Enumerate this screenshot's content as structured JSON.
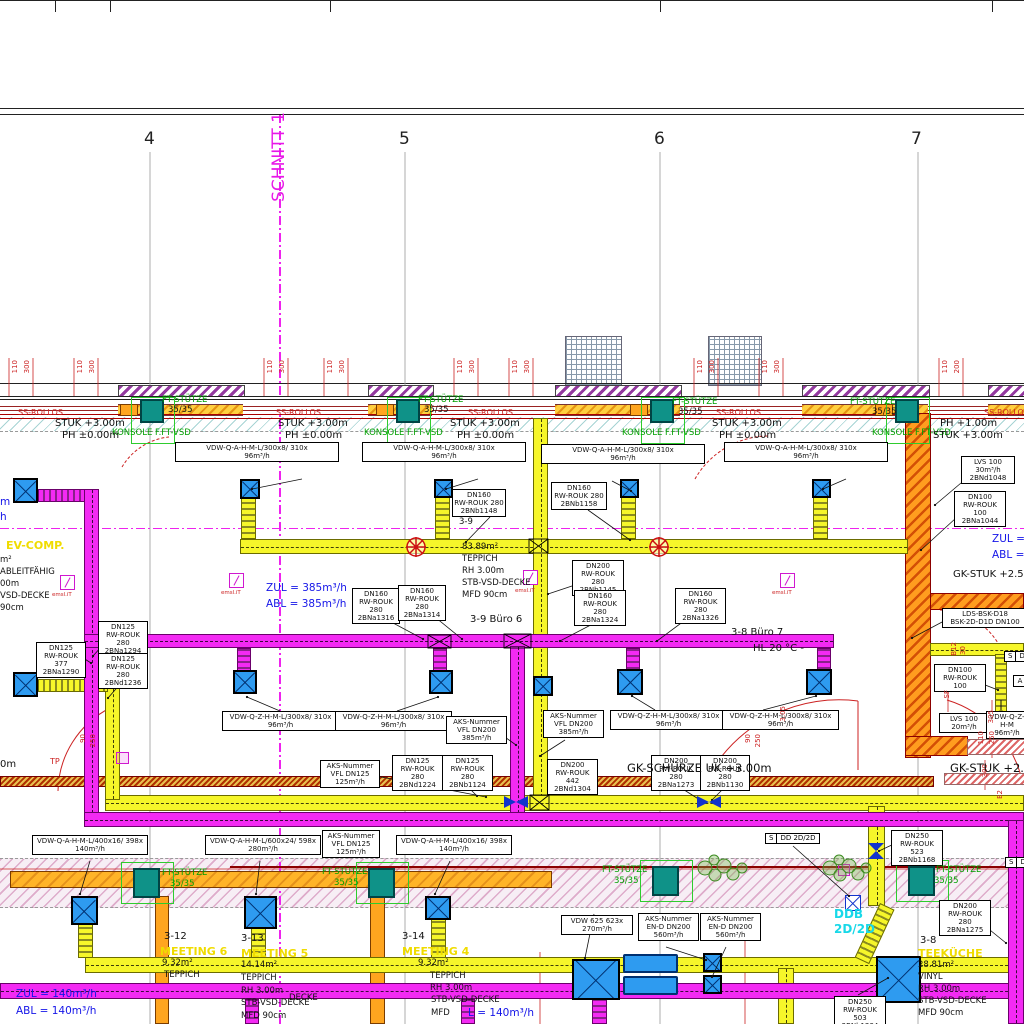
{
  "drawing": {
    "section_label": "SCHNITT 1"
  },
  "grid_axes": [
    "4",
    "5",
    "6",
    "7"
  ],
  "colors": {
    "supply_duct_yellow": "#f6f62a",
    "exhaust_duct_magenta": "#f32af3",
    "column_teal": "#0f9288",
    "wall_orange": "#ff9d1f",
    "purple_hatch": "#93399f",
    "annotation_green": "#00a000",
    "dimension_red": "#cc2222",
    "info_blue": "#1515e8",
    "room_name_yellow": "#f0dc00",
    "ddb_cyan": "#18d8e8",
    "section_magenta": "#e818e8"
  },
  "icons": {
    "diffuser-icon": "blue square with X cross",
    "fire-damper-icon": "red wheel circle",
    "damper-icon": "blue bowtie",
    "vsd-actuator-icon": "magenta square with slash",
    "plant-icon": "green shrub cluster"
  },
  "flags": [
    {
      "x": 765,
      "y": 833,
      "cells": [
        "S",
        "DD 2D/2D"
      ]
    },
    {
      "x": 1004,
      "y": 651,
      "cells": [
        "S",
        "D"
      ]
    },
    {
      "x": 1005,
      "y": 857,
      "cells": [
        "S",
        "DG"
      ]
    }
  ],
  "labels": [
    {
      "t": "4",
      "x": 144,
      "y": 130,
      "c": "gn",
      "n": "grid-axis-4"
    },
    {
      "t": "5",
      "x": 399,
      "y": 130,
      "c": "gn",
      "n": "grid-axis-5"
    },
    {
      "t": "6",
      "x": 654,
      "y": 130,
      "c": "gn",
      "n": "grid-axis-6"
    },
    {
      "t": "7",
      "x": 911,
      "y": 130,
      "c": "gn",
      "n": "grid-axis-7"
    },
    {
      "t": "SCHNITT 1",
      "x": 270,
      "y": 112,
      "c": "m",
      "n": "section-label"
    },
    {
      "t": "110",
      "x": 12,
      "y": 360,
      "c": "rv"
    },
    {
      "t": "300",
      "x": 24,
      "y": 360,
      "c": "rv"
    },
    {
      "t": "110",
      "x": 77,
      "y": 360,
      "c": "rv"
    },
    {
      "t": "300",
      "x": 89,
      "y": 360,
      "c": "rv"
    },
    {
      "t": "110",
      "x": 267,
      "y": 360,
      "c": "rv"
    },
    {
      "t": "300",
      "x": 279,
      "y": 360,
      "c": "rv"
    },
    {
      "t": "110",
      "x": 327,
      "y": 360,
      "c": "rv"
    },
    {
      "t": "300",
      "x": 339,
      "y": 360,
      "c": "rv"
    },
    {
      "t": "110",
      "x": 457,
      "y": 360,
      "c": "rv"
    },
    {
      "t": "300",
      "x": 469,
      "y": 360,
      "c": "rv"
    },
    {
      "t": "110",
      "x": 512,
      "y": 360,
      "c": "rv"
    },
    {
      "t": "300",
      "x": 524,
      "y": 360,
      "c": "rv"
    },
    {
      "t": "110",
      "x": 697,
      "y": 360,
      "c": "rv"
    },
    {
      "t": "300",
      "x": 709,
      "y": 360,
      "c": "rv"
    },
    {
      "t": "110",
      "x": 762,
      "y": 360,
      "c": "rv"
    },
    {
      "t": "300",
      "x": 774,
      "y": 360,
      "c": "rv"
    },
    {
      "t": "110",
      "x": 942,
      "y": 360,
      "c": "rv"
    },
    {
      "t": "200",
      "x": 954,
      "y": 360,
      "c": "rv"
    },
    {
      "t": "FT-STÜTZE",
      "x": 162,
      "y": 396,
      "c": "g"
    },
    {
      "t": "35/35",
      "x": 168,
      "y": 406,
      "c": "t9"
    },
    {
      "t": "FT-STÜTZE",
      "x": 418,
      "y": 396,
      "c": "g"
    },
    {
      "t": "35/35",
      "x": 424,
      "y": 406,
      "c": "t9"
    },
    {
      "t": "FT-STÜTZE",
      "x": 672,
      "y": 398,
      "c": "g"
    },
    {
      "t": "35/35",
      "x": 678,
      "y": 408,
      "c": "t9"
    },
    {
      "t": "FT-STÜTZE",
      "x": 850,
      "y": 398,
      "c": "g"
    },
    {
      "t": "35/35",
      "x": 872,
      "y": 408,
      "c": "t9"
    },
    {
      "t": "KONSOLE F.FT-VSD",
      "x": 112,
      "y": 429,
      "c": "g"
    },
    {
      "t": "KONSOLE F.FT-VSD",
      "x": 364,
      "y": 429,
      "c": "g"
    },
    {
      "t": "KONSOLE F.FT-VSD",
      "x": 622,
      "y": 429,
      "c": "g"
    },
    {
      "t": "KONSOLE F.FT-VSD",
      "x": 872,
      "y": 429,
      "c": "g"
    },
    {
      "t": "SS-ROLLOS",
      "x": 18,
      "y": 409,
      "c": "r"
    },
    {
      "t": "SS-ROLLOS",
      "x": 276,
      "y": 409,
      "c": "r"
    },
    {
      "t": "SS-ROLLOS",
      "x": 468,
      "y": 409,
      "c": "r"
    },
    {
      "t": "SS-ROLLOS",
      "x": 716,
      "y": 409,
      "c": "r"
    },
    {
      "t": "SS-ROLLOS",
      "x": 984,
      "y": 409,
      "c": "r"
    },
    {
      "t": "STUK +3.00m",
      "x": 55,
      "y": 419,
      "c": "t10"
    },
    {
      "t": "PH ±0.00m",
      "x": 62,
      "y": 431,
      "c": "t10"
    },
    {
      "t": "STUK +3.00m",
      "x": 278,
      "y": 419,
      "c": "t10"
    },
    {
      "t": "PH ±0.00m",
      "x": 285,
      "y": 431,
      "c": "t10"
    },
    {
      "t": "STUK +3.00m",
      "x": 450,
      "y": 419,
      "c": "t10"
    },
    {
      "t": "PH ±0.00m",
      "x": 457,
      "y": 431,
      "c": "t10"
    },
    {
      "t": "STUK +3.00m",
      "x": 712,
      "y": 419,
      "c": "t10"
    },
    {
      "t": "PH ±0.00m",
      "x": 719,
      "y": 431,
      "c": "t10"
    },
    {
      "t": "PH +1.00m",
      "x": 940,
      "y": 419,
      "c": "t10"
    },
    {
      "t": "STUK +3.00m",
      "x": 933,
      "y": 431,
      "c": "t10"
    },
    {
      "t": "VDW-Q-A-H-M-L/300x8/ 310x\n96m³/h",
      "x": 175,
      "y": 442,
      "w": 160,
      "c": "box"
    },
    {
      "t": "VDW-Q-A-H-M-L/300x8/ 310x\n96m³/h",
      "x": 362,
      "y": 442,
      "w": 160,
      "c": "box"
    },
    {
      "t": "VDW-Q-A-H-M-L/300x8/ 310x\n96m³/h",
      "x": 541,
      "y": 444,
      "w": 160,
      "c": "box"
    },
    {
      "t": "VDW-Q-A-H-M-L/300x8/ 310x\n96m³/h",
      "x": 724,
      "y": 442,
      "w": 160,
      "c": "box"
    },
    {
      "t": "DN160\nRW-ROUK 280\n2BNb1148",
      "x": 452,
      "y": 489,
      "w": 50,
      "c": "box"
    },
    {
      "t": "DN160\nRW-ROUK 280\n2BNb1158",
      "x": 551,
      "y": 482,
      "w": 52,
      "c": "box"
    },
    {
      "t": "3-9",
      "x": 459,
      "y": 518,
      "c": "t9"
    },
    {
      "t": "LVS 100\n30m³/h\n2BNd1048",
      "x": 961,
      "y": 456,
      "w": 50,
      "c": "box"
    },
    {
      "t": "DN100\nRW-ROUK 100\n2BNa1044",
      "x": 954,
      "y": 491,
      "w": 48,
      "c": "box"
    },
    {
      "t": "m",
      "x": 0,
      "y": 497,
      "c": "b"
    },
    {
      "t": "h",
      "x": 0,
      "y": 512,
      "c": "b"
    },
    {
      "t": "EV-COMP.",
      "x": 6,
      "y": 540,
      "c": "y",
      "n": "room-name"
    },
    {
      "t": "m²",
      "x": 0,
      "y": 556,
      "c": "t9"
    },
    {
      "t": "ABLEITFÄHIG",
      "x": 0,
      "y": 568,
      "c": "t9"
    },
    {
      "t": "00m",
      "x": 0,
      "y": 580,
      "c": "t9"
    },
    {
      "t": "VSD-DECKE",
      "x": 0,
      "y": 592,
      "c": "t9"
    },
    {
      "t": "90cm",
      "x": 0,
      "y": 604,
      "c": "t9"
    },
    {
      "t": "ZUL = 385m³/h",
      "x": 266,
      "y": 583,
      "c": "b"
    },
    {
      "t": "ABL = 385m³/h",
      "x": 266,
      "y": 599,
      "c": "b"
    },
    {
      "t": "ZUL =",
      "x": 992,
      "y": 534,
      "c": "b"
    },
    {
      "t": "ABL =",
      "x": 992,
      "y": 550,
      "c": "b"
    },
    {
      "t": "83.89m²",
      "x": 462,
      "y": 543,
      "c": "t9"
    },
    {
      "t": "TEPPICH",
      "x": 462,
      "y": 555,
      "c": "t9"
    },
    {
      "t": "RH 3.00m",
      "x": 462,
      "y": 567,
      "c": "t9"
    },
    {
      "t": "STB-VSD-DECKE",
      "x": 462,
      "y": 579,
      "c": "t9"
    },
    {
      "t": "MFD 90cm",
      "x": 462,
      "y": 591,
      "c": "t9"
    },
    {
      "t": "3-9 Büro 6",
      "x": 470,
      "y": 615,
      "c": "t10",
      "n": "room-label"
    },
    {
      "t": "3-8 Büro 7",
      "x": 731,
      "y": 628,
      "c": "t10",
      "n": "room-label"
    },
    {
      "t": "HL 20 °C -",
      "x": 753,
      "y": 644,
      "c": "t10"
    },
    {
      "t": "GK-STUK +2.58",
      "x": 953,
      "y": 570,
      "c": "t10"
    },
    {
      "t": "DN160\nRW-ROUK 280\n2BNa1316",
      "x": 352,
      "y": 588,
      "w": 44,
      "c": "box"
    },
    {
      "t": "DN160\nRW-ROUK 280\n2BNa1314",
      "x": 398,
      "y": 585,
      "w": 44,
      "c": "box"
    },
    {
      "t": "DN200\nRW-ROUK 280\n2BNb1145",
      "x": 572,
      "y": 560,
      "w": 48,
      "c": "box"
    },
    {
      "t": "DN160\nRW-ROUK 280\n2BNa1324",
      "x": 574,
      "y": 590,
      "w": 48,
      "c": "box"
    },
    {
      "t": "DN160\nRW-ROUK 280\n2BNa1326",
      "x": 675,
      "y": 588,
      "w": 47,
      "c": "box"
    },
    {
      "t": "DN125\nRW-ROUK 377\n2BNa1290",
      "x": 36,
      "y": 642,
      "w": 46,
      "c": "box"
    },
    {
      "t": "DN125\nRW-ROUK 280\n2BNa1294",
      "x": 98,
      "y": 621,
      "w": 46,
      "c": "box"
    },
    {
      "t": "DN125\nRW-ROUK 280\n2BNd1236",
      "x": 98,
      "y": 653,
      "w": 46,
      "c": "box"
    },
    {
      "t": "LDS-BSK-D18\nBSK-2D-D1D DN100",
      "x": 942,
      "y": 608,
      "w": 82,
      "c": "box"
    },
    {
      "t": "DN100\nRW-ROUK 100",
      "x": 934,
      "y": 664,
      "w": 48,
      "c": "box"
    },
    {
      "t": "LVS 100\n20m³/h",
      "x": 939,
      "y": 713,
      "w": 46,
      "c": "box"
    },
    {
      "t": "A",
      "x": 1013,
      "y": 675,
      "w": 10,
      "c": "box"
    },
    {
      "t": "VDW-Q-Z-H-M-L/300x8/ 310x\n96m³/h",
      "x": 222,
      "y": 711,
      "w": 113,
      "c": "box"
    },
    {
      "t": "VDW-Q-Z-H-M-L/300x8/ 310x\n96m³/h",
      "x": 335,
      "y": 711,
      "w": 113,
      "c": "box"
    },
    {
      "t": "VDW-Q-Z-H-M-L/300x8/ 310x\n96m³/h",
      "x": 610,
      "y": 710,
      "w": 113,
      "c": "box"
    },
    {
      "t": "VDW-Q-Z-H-M-L/300x8/ 310x\n96m³/h",
      "x": 722,
      "y": 710,
      "w": 113,
      "c": "box"
    },
    {
      "t": "VDW-Q-Z-H-M\n96m³/h",
      "x": 986,
      "y": 711,
      "w": 38,
      "c": "box"
    },
    {
      "t": "AKS-Nummer\nVFL DN200\n385m³/h",
      "x": 446,
      "y": 716,
      "w": 57,
      "c": "box"
    },
    {
      "t": "AKS-Nummer\nVFL DN200\n385m³/h",
      "x": 543,
      "y": 710,
      "w": 57,
      "c": "box"
    },
    {
      "t": "AKS-Nummer\nVFL DN125\n125m³/h",
      "x": 320,
      "y": 760,
      "w": 56,
      "c": "box"
    },
    {
      "t": "DN125\nRW-ROUK 280\n2BNd1224",
      "x": 392,
      "y": 755,
      "w": 47,
      "c": "box"
    },
    {
      "t": "DN125\nRW-ROUK 280\n2BNb1124",
      "x": 442,
      "y": 755,
      "w": 47,
      "c": "box"
    },
    {
      "t": "DN200\nRW-ROUK 442\n2BNd1304",
      "x": 547,
      "y": 759,
      "w": 47,
      "c": "box"
    },
    {
      "t": "DN200\nRW-ROUK 280\n2BNa1273",
      "x": 651,
      "y": 755,
      "w": 46,
      "c": "box"
    },
    {
      "t": "DN200\nRW-ROUK 280\n2BNb1130",
      "x": 700,
      "y": 755,
      "w": 46,
      "c": "box"
    },
    {
      "t": "90",
      "x": 745,
      "y": 734,
      "c": "rv"
    },
    {
      "t": "250",
      "x": 755,
      "y": 734,
      "c": "rv"
    },
    {
      "t": "3.05",
      "x": 780,
      "y": 706,
      "c": "rv"
    },
    {
      "t": "90",
      "x": 80,
      "y": 734,
      "c": "rv"
    },
    {
      "t": "250",
      "x": 90,
      "y": 734,
      "c": "rv"
    },
    {
      "t": "TP",
      "x": 50,
      "y": 758,
      "c": "r"
    },
    {
      "t": "B12",
      "x": 951,
      "y": 642,
      "c": "rv"
    },
    {
      "t": "30",
      "x": 960,
      "y": 646,
      "c": "rv"
    },
    {
      "t": "SF",
      "x": 944,
      "y": 690,
      "c": "rv"
    },
    {
      "t": "305",
      "x": 988,
      "y": 710,
      "c": "rv"
    },
    {
      "t": "110",
      "x": 978,
      "y": 731,
      "c": "rv"
    },
    {
      "t": "250",
      "x": 989,
      "y": 731,
      "c": "rv"
    },
    {
      "t": "300",
      "x": 982,
      "y": 764,
      "c": "rv"
    },
    {
      "t": "E2",
      "x": 997,
      "y": 790,
      "c": "rv"
    },
    {
      "t": "GK-SCHÜRZE UK +3.00m",
      "x": 627,
      "y": 762,
      "c": "t11"
    },
    {
      "t": "GK-STUK +2.5",
      "x": 950,
      "y": 762,
      "c": "t11"
    },
    {
      "t": "0m",
      "x": 0,
      "y": 760,
      "c": "t10"
    },
    {
      "t": "emsl.iT",
      "x": 52,
      "y": 593,
      "c": "rt"
    },
    {
      "t": "emsl.iT",
      "x": 221,
      "y": 591,
      "c": "rt"
    },
    {
      "t": "emsl.iT",
      "x": 515,
      "y": 589,
      "c": "rt"
    },
    {
      "t": "emsl.iT",
      "x": 772,
      "y": 591,
      "c": "rt"
    },
    {
      "t": "VDW-Q-A-H-M-L/400x16/ 398x\n140m³/h",
      "x": 32,
      "y": 835,
      "w": 112,
      "c": "box"
    },
    {
      "t": "VDW-Q-A-H-M-L/600x24/ 598x\n280m³/h",
      "x": 205,
      "y": 835,
      "w": 112,
      "c": "box"
    },
    {
      "t": "AKS-Nummer\nVFL DN125\n125m³/h",
      "x": 322,
      "y": 830,
      "w": 54,
      "c": "box"
    },
    {
      "t": "VDW-Q-A-H-M-L/400x16/ 398x\n140m³/h",
      "x": 396,
      "y": 835,
      "w": 112,
      "c": "box"
    },
    {
      "t": "DN250\nRW-ROUK 523\n2BNb1168",
      "x": 891,
      "y": 830,
      "w": 48,
      "c": "box"
    },
    {
      "t": "FT-STÜTZE",
      "x": 162,
      "y": 869,
      "c": "g"
    },
    {
      "t": "35/35",
      "x": 170,
      "y": 880,
      "c": "g"
    },
    {
      "t": "FT-STÜTZE",
      "x": 322,
      "y": 868,
      "c": "g"
    },
    {
      "t": "35/35",
      "x": 334,
      "y": 879,
      "c": "g"
    },
    {
      "t": "FT-STÜTZE",
      "x": 602,
      "y": 866,
      "c": "g"
    },
    {
      "t": "35/35",
      "x": 614,
      "y": 877,
      "c": "g"
    },
    {
      "t": "FT-STÜTZE",
      "x": 936,
      "y": 866,
      "c": "g"
    },
    {
      "t": "35/35",
      "x": 934,
      "y": 877,
      "c": "g"
    },
    {
      "t": "DN200\nRW-ROUK 280\n2BNa1275",
      "x": 939,
      "y": 900,
      "w": 48,
      "c": "box"
    },
    {
      "t": "DDB",
      "x": 834,
      "y": 908,
      "c": "c"
    },
    {
      "t": "2D/2D",
      "x": 834,
      "y": 923,
      "c": "c"
    },
    {
      "t": "VDW 625 623x\n270m³/h",
      "x": 561,
      "y": 915,
      "w": 68,
      "c": "box"
    },
    {
      "t": "AKS-Nummer\nEN-D DN200\n560m³/h",
      "x": 638,
      "y": 913,
      "w": 57,
      "c": "box"
    },
    {
      "t": "AKS-Nummer\nEN-D DN200\n560m³/h",
      "x": 700,
      "y": 913,
      "w": 57,
      "c": "box"
    },
    {
      "t": "DN250\nRW-ROUK 503\n2BNb1234",
      "x": 834,
      "y": 996,
      "w": 48,
      "c": "box"
    },
    {
      "t": "3-12",
      "x": 164,
      "y": 932,
      "c": "t10",
      "n": "room-label"
    },
    {
      "t": "MEETING 6",
      "x": 160,
      "y": 946,
      "c": "y",
      "n": "room-name"
    },
    {
      "t": "9.32m²",
      "x": 162,
      "y": 959,
      "c": "t9"
    },
    {
      "t": "TEPPICH",
      "x": 164,
      "y": 971,
      "c": "t9"
    },
    {
      "t": "DECKE",
      "x": 289,
      "y": 994,
      "c": "t9"
    },
    {
      "t": "ZUL = 140m³/h",
      "x": 16,
      "y": 989,
      "c": "b"
    },
    {
      "t": "ABL = 140m³/h",
      "x": 16,
      "y": 1006,
      "c": "b"
    },
    {
      "t": "3-13",
      "x": 241,
      "y": 934,
      "c": "t10",
      "n": "room-label"
    },
    {
      "t": "MEETING 5",
      "x": 241,
      "y": 948,
      "c": "y",
      "n": "room-name"
    },
    {
      "t": "14.14m²",
      "x": 241,
      "y": 961,
      "c": "t9"
    },
    {
      "t": "TEPPICH",
      "x": 241,
      "y": 974,
      "c": "t9"
    },
    {
      "t": "RH 3.00m",
      "x": 241,
      "y": 987,
      "c": "t9"
    },
    {
      "t": "STB-VSD-DECKE",
      "x": 241,
      "y": 999,
      "c": "t9"
    },
    {
      "t": "MFD 90cm",
      "x": 241,
      "y": 1012,
      "c": "t9"
    },
    {
      "t": "3-14",
      "x": 402,
      "y": 932,
      "c": "t10",
      "n": "room-label"
    },
    {
      "t": "MEETING 4",
      "x": 402,
      "y": 946,
      "c": "y",
      "n": "room-name"
    },
    {
      "t": "9.32m²",
      "x": 418,
      "y": 959,
      "c": "t9"
    },
    {
      "t": "TEPPICH",
      "x": 430,
      "y": 972,
      "c": "t9"
    },
    {
      "t": "RH 3.00m",
      "x": 430,
      "y": 984,
      "c": "t9"
    },
    {
      "t": "STB-VSD-DECKE",
      "x": 431,
      "y": 996,
      "c": "t9"
    },
    {
      "t": "MFD",
      "x": 431,
      "y": 1009,
      "c": "t9"
    },
    {
      "t": "L = 140m³/h",
      "x": 468,
      "y": 1008,
      "c": "b"
    },
    {
      "t": "3-8",
      "x": 920,
      "y": 936,
      "c": "t10",
      "n": "room-label"
    },
    {
      "t": "TEEKÜCHE",
      "x": 918,
      "y": 948,
      "c": "y",
      "n": "room-name"
    },
    {
      "t": "28.81m²",
      "x": 918,
      "y": 961,
      "c": "t9"
    },
    {
      "t": "VINYL",
      "x": 918,
      "y": 973,
      "c": "t9"
    },
    {
      "t": "RH 3.00m",
      "x": 918,
      "y": 985,
      "c": "t9"
    },
    {
      "t": "STB-VSD-DECKE",
      "x": 918,
      "y": 997,
      "c": "t9"
    },
    {
      "t": "MFD 90cm",
      "x": 918,
      "y": 1009,
      "c": "t9"
    }
  ]
}
